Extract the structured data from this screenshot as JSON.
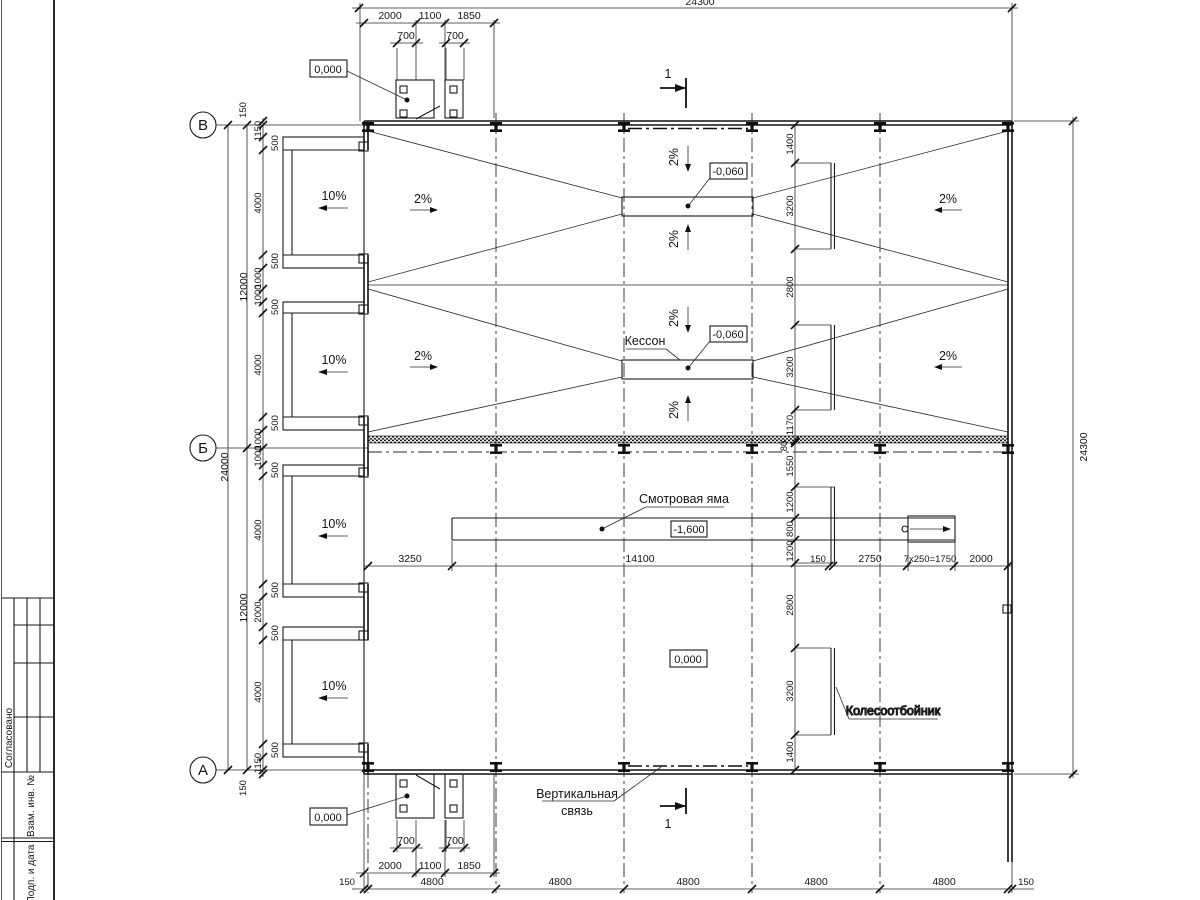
{
  "axis_labels": {
    "v": "В",
    "b": "Б",
    "a": "А"
  },
  "dims": {
    "total_w": "24300",
    "total_h": "24300",
    "left_total": "24000",
    "half": "12000",
    "d150": "150",
    "d1150": "1150",
    "d500": "500",
    "d4000": "4000",
    "d1000": "1000",
    "d2000": "2000",
    "d1100": "1100",
    "d1850": "1850",
    "d700": "700",
    "d4800": "4800",
    "d1400": "1400",
    "d3200": "3200",
    "d2800": "2800",
    "d1170": "1170",
    "d80": "80",
    "d1550": "1550",
    "d1200": "1200",
    "d800": "800",
    "d3250": "3250",
    "d14100": "14100",
    "d2750": "2750",
    "stair_run": "7x250=1750"
  },
  "levels": {
    "zero": "0,000",
    "minus060": "-0,060",
    "minus1600": "-1,600"
  },
  "slopes": {
    "ramp": "10%",
    "floor": "2%"
  },
  "notes": {
    "caisson": "Кессон",
    "pit": "Смотровая яма",
    "wheel_stop": "Колесоотбойник",
    "brace_line1": "Вертикальная",
    "brace_line2": "связь"
  },
  "section_mark": "1",
  "title_block": {
    "agreed": "Согласовано",
    "repl_inv": "Взам. инв. №",
    "sign_date": "Подп. и дата"
  }
}
